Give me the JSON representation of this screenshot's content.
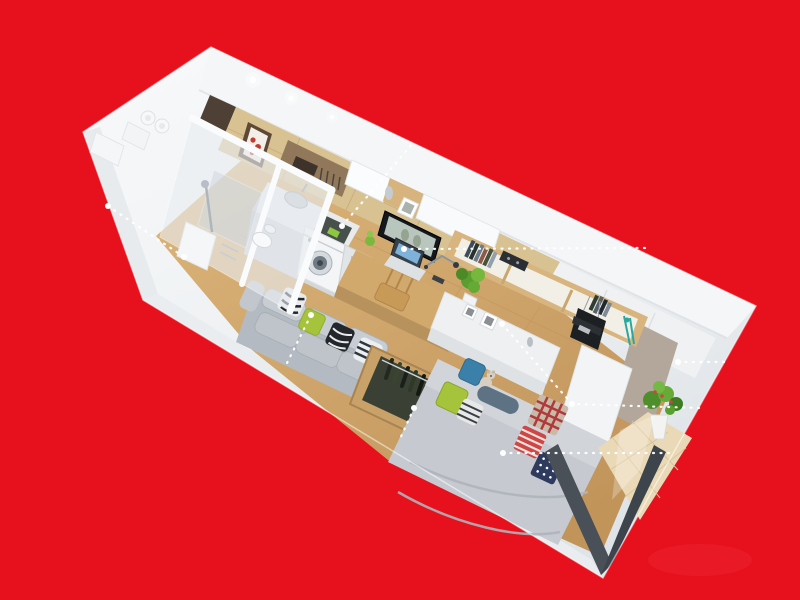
{
  "canvas": {
    "width": 800,
    "height": 600
  },
  "scene": {
    "description": "3D isometric cutaway render of a studio apartment on a red background",
    "rooms": [
      "bathroom",
      "entry",
      "kitchen",
      "workspace",
      "living-area",
      "sleeping-area",
      "balcony"
    ],
    "objects": [
      "vent-pipes",
      "shower",
      "toilet",
      "artwork",
      "utensil-rack",
      "wall-cabinets",
      "sink",
      "cooktop",
      "washing-machine",
      "mini-fridge",
      "desk",
      "chair",
      "laptop",
      "desk-lamp",
      "tv",
      "bookshelf",
      "books",
      "stereo",
      "sideboard",
      "picture-frames",
      "hanging-bag",
      "umbrella",
      "sofa",
      "cushions",
      "open-wardrobe",
      "hanging-clothes",
      "bed",
      "flag-pillows",
      "teddy-bear",
      "potted-plant",
      "sliding-door-frame",
      "spotlights"
    ]
  },
  "palette": {
    "background_red": "#e7111d",
    "slab_white": "#f1f3f5",
    "wall_top": "#f5f6f7",
    "tile_wall": "#d9c292",
    "entry_wall": "#4e4034",
    "floor_wood": "#d4ad74",
    "counter": "#e8eaec",
    "desk_wood": "#d2a96d",
    "sofa_gray": "#b4bac2",
    "bed_gray": "#c6cad0",
    "pillow_green": "#a6c33c",
    "pillow_blue": "#3b80a9",
    "wardrobe_wood": "#c9a269",
    "clothes_dark": "#3a4033",
    "balcony_tile": "#ead9b6",
    "frame_dark": "#4a5057",
    "taupe_wall": "#b3a69b",
    "plant_green": "#4e8f2c",
    "flag_red": "#cf4646",
    "flag_navy": "#2e3b5f",
    "artwork_red": "#c23b32"
  },
  "callouts": {
    "stroke": "#ffffff",
    "dot_radius": 3,
    "lines": [
      {
        "name": "bathroom",
        "points": [
          [
            108,
            206
          ],
          [
            184,
            257
          ]
        ],
        "dots": [
          [
            108,
            206
          ],
          [
            184,
            257
          ]
        ]
      },
      {
        "name": "kitchen",
        "points": [
          [
            342,
            226
          ],
          [
            413,
            143
          ]
        ],
        "dots": [
          [
            342,
            226
          ]
        ]
      },
      {
        "name": "tv-wall",
        "points": [
          [
            404,
            249
          ],
          [
            645,
            248
          ]
        ],
        "dots": [
          [
            404,
            249
          ]
        ]
      },
      {
        "name": "sofa",
        "points": [
          [
            311,
            315
          ],
          [
            286,
            365
          ]
        ],
        "dots": [
          [
            311,
            315
          ]
        ]
      },
      {
        "name": "wardrobe",
        "points": [
          [
            414,
            408
          ],
          [
            399,
            441
          ]
        ],
        "dots": [
          [
            414,
            408
          ]
        ]
      },
      {
        "name": "bed-head",
        "points": [
          [
            502,
            324
          ],
          [
            572,
            404
          ],
          [
            699,
            408
          ]
        ],
        "dots": [
          [
            502,
            324
          ],
          [
            572,
            404
          ]
        ]
      },
      {
        "name": "bed",
        "points": [
          [
            503,
            453
          ],
          [
            674,
            453
          ]
        ],
        "dots": [
          [
            503,
            453
          ]
        ]
      },
      {
        "name": "balcony-window",
        "points": [
          [
            678,
            362
          ],
          [
            724,
            362
          ]
        ],
        "dots": [
          [
            678,
            362
          ]
        ]
      }
    ]
  }
}
